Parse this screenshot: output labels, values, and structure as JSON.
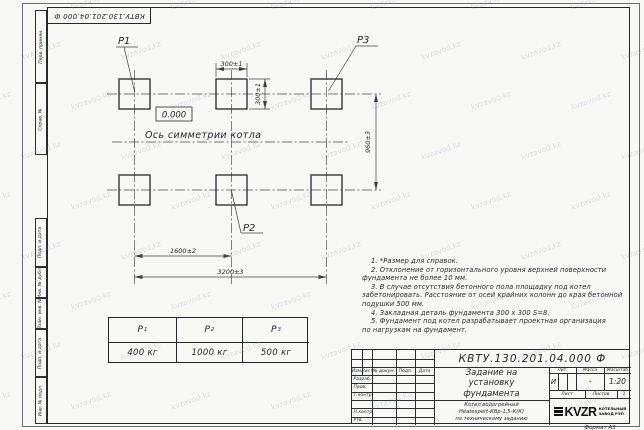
{
  "watermark": {
    "text": "kvzavod.kz"
  },
  "stamp_top": "КВТУ.130.201.04.000 Ф",
  "side_labels": [
    "Перв. примен.",
    "Справ. №",
    "Подп. и дата",
    "Инв. № дубл.",
    "Взам. инв. №",
    "Подп. и дата",
    "Инв. № подл."
  ],
  "drawing": {
    "point_labels": {
      "p1": "P1",
      "p2": "P2",
      "p3": "P3"
    },
    "elevation": "0.000",
    "axis_label": "Ось симметрии котла",
    "dimensions": {
      "pad_width": "300±1",
      "pad_height": "300±1",
      "row_spacing": "960±3",
      "col_spacing": "1600±2",
      "total_width": "3200±3"
    }
  },
  "notes_lines": [
    {
      "t": "1. *Размер для справок."
    },
    {
      "t": "2. Отклонение от горизонтального уровня верхней поверхности"
    },
    {
      "t": "фундамента не более 10 мм."
    },
    {
      "t": "3. В случае отсутствия бетонного пола площадку под котел"
    },
    {
      "t": "забетонировать. Расстояние от осей крайних колонн до края бетонной"
    },
    {
      "t": "подушки 500 мм."
    },
    {
      "t": "4. Закладная деталь фундамента 300 х 300 S=8."
    },
    {
      "t": "5. Фундамент под котел разрабатывает проектная организация"
    },
    {
      "t": "по нагрузкам на фундамент."
    }
  ],
  "load_table": {
    "columns": [
      {
        "name": "P",
        "sub": "1",
        "value": "400 кг"
      },
      {
        "name": "P",
        "sub": "2",
        "value": "1000 кг"
      },
      {
        "name": "P",
        "sub": "3",
        "value": "500 кг"
      }
    ]
  },
  "title_block": {
    "doc_number": "КВТУ.130.201.04.000 Ф",
    "header_cols": [
      "Изм.",
      "Лист",
      "№ докум.",
      "Подп.",
      "Дата"
    ],
    "sign_rows": [
      "Разраб.",
      "Пров.",
      "Т.контр.",
      "",
      "Н.контр.",
      "Утв."
    ],
    "title_lines": [
      "Задание на",
      "установку",
      "фундамента"
    ],
    "product_lines": [
      "Котел водогрейный",
      "Heatexpert-КВр-1,5-К(К)",
      "по техническому заданию"
    ],
    "lit_label": "Лит.",
    "lit_value": "И",
    "mass_label": "Масса",
    "mass_value": "-",
    "scale_label": "Масштаб",
    "scale_value": "1:20",
    "sheet_label": "Лист",
    "sheets_label": "Листов",
    "sheets_value": "1",
    "logo": {
      "text": "KVZR",
      "sub_lines": [
        "КОТЕЛЬНЫЙ",
        "ЗАВОД РЭП"
      ]
    }
  },
  "format_label": "Формат А3"
}
